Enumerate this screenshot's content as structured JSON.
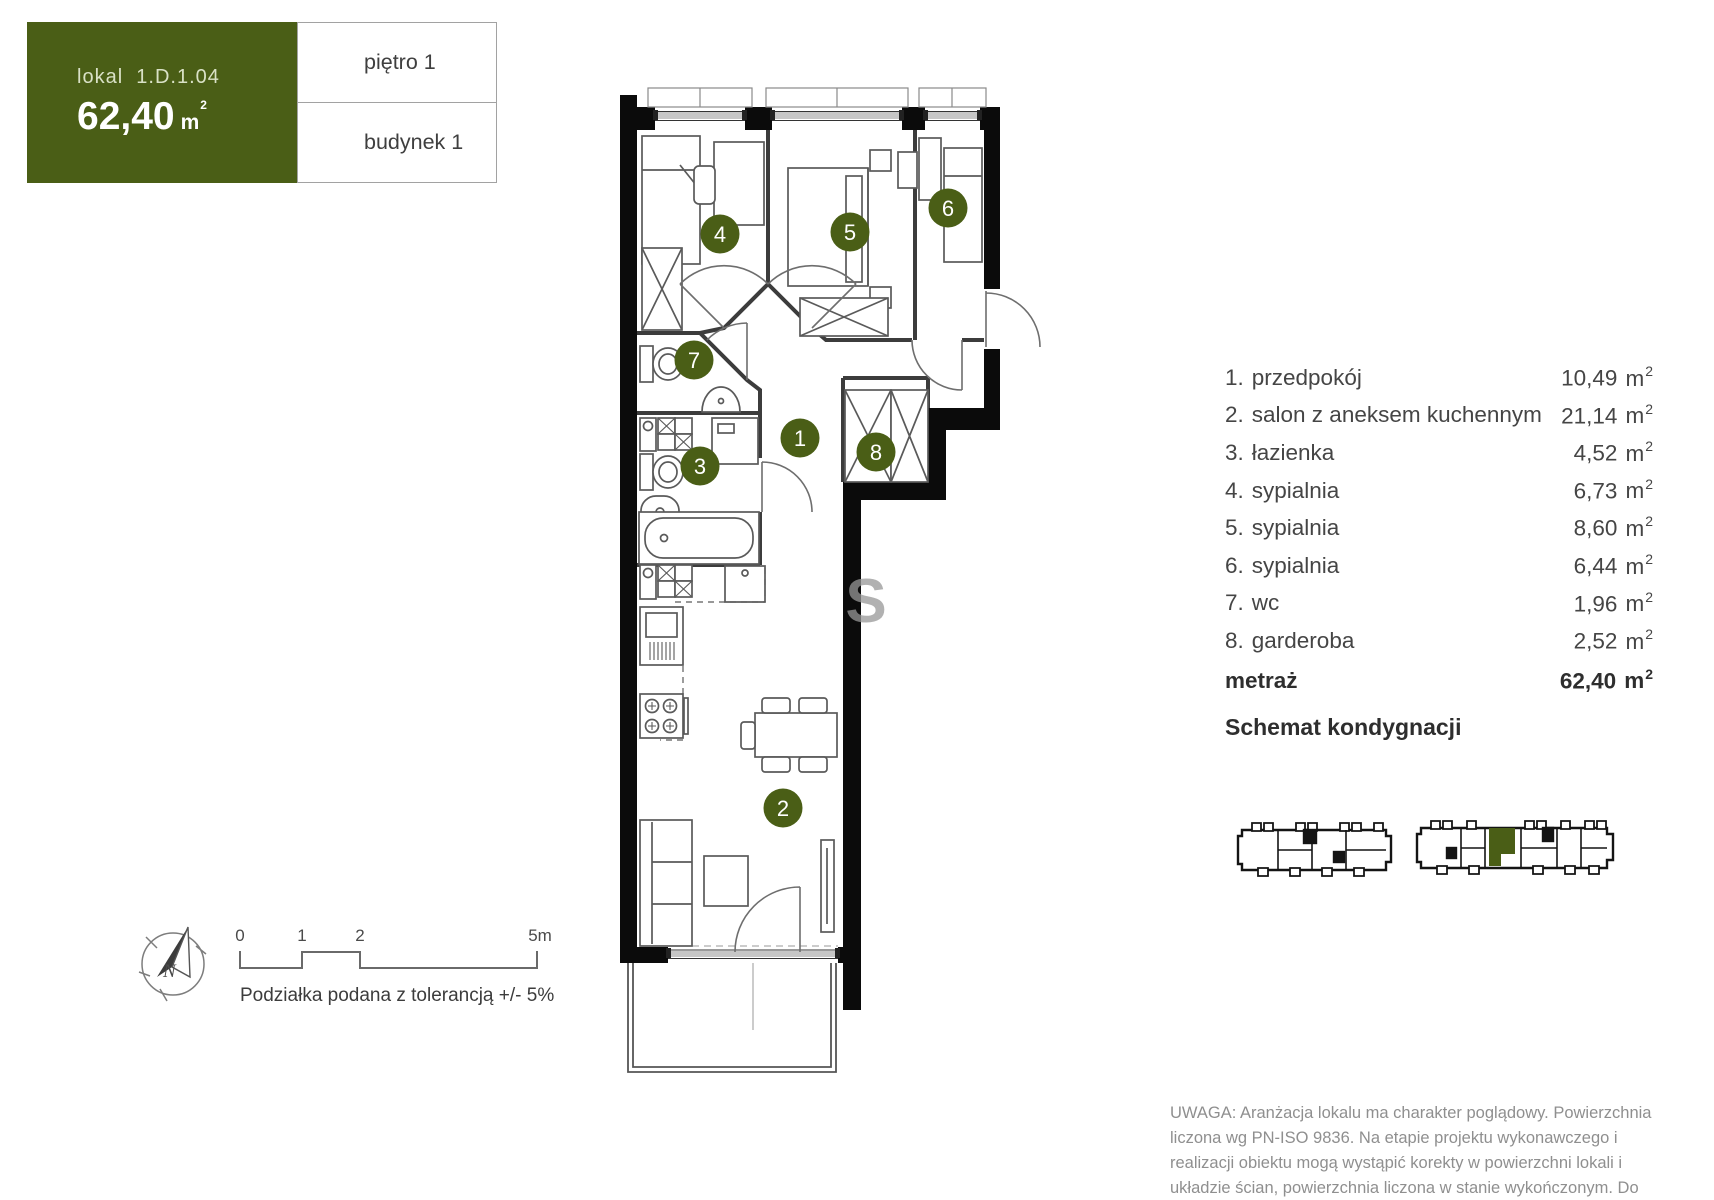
{
  "header": {
    "lokal_label": "lokal",
    "lokal_value": "1.D.1.04",
    "area_value": "62,40",
    "floor_label": "piętro 1",
    "building_label": "budynek 1"
  },
  "units": {
    "base": "m",
    "sup": "2"
  },
  "legend": {
    "rows": [
      {
        "num": "1.",
        "label": "przedpokój",
        "value": "10,49"
      },
      {
        "num": "2.",
        "label": "salon z aneksem kuchennym",
        "value": "21,14"
      },
      {
        "num": "3.",
        "label": "łazienka",
        "value": "4,52"
      },
      {
        "num": "4.",
        "label": "sypialnia",
        "value": "6,73"
      },
      {
        "num": "5.",
        "label": "sypialnia",
        "value": "8,60"
      },
      {
        "num": "6.",
        "label": "sypialnia",
        "value": "6,44"
      },
      {
        "num": "7.",
        "label": "wc",
        "value": "1,96"
      },
      {
        "num": "8.",
        "label": "garderoba",
        "value": "2,52"
      }
    ],
    "total_label": "metraż",
    "total_value": "62,40",
    "schema_heading": "Schemat kondygnacji"
  },
  "plan": {
    "badges": [
      {
        "n": "1"
      },
      {
        "n": "2"
      },
      {
        "n": "3"
      },
      {
        "n": "4"
      },
      {
        "n": "5"
      },
      {
        "n": "6"
      },
      {
        "n": "7"
      },
      {
        "n": "8"
      }
    ],
    "watermark": "S"
  },
  "scale_bar": {
    "ticks": [
      "0",
      "1",
      "2",
      "5m"
    ],
    "note": "Podziałka podana z tolerancją +/- 5%"
  },
  "compass": {
    "north_label": "N"
  },
  "disclaimer": "UWAGA: Aranżacja lokalu ma charakter poglądowy. Powierzchnia liczona wg PN-ISO 9836. Na etapie projektu wykonawczego i realizacji obiektu mogą wystąpić korekty w powierzchni lokali i układzie ścian, powierzchnia liczona w stanie wykończonym. Do obliczeń przyjęto 1,5cm tynku.",
  "colors": {
    "accent_green": "#4a5e16"
  }
}
